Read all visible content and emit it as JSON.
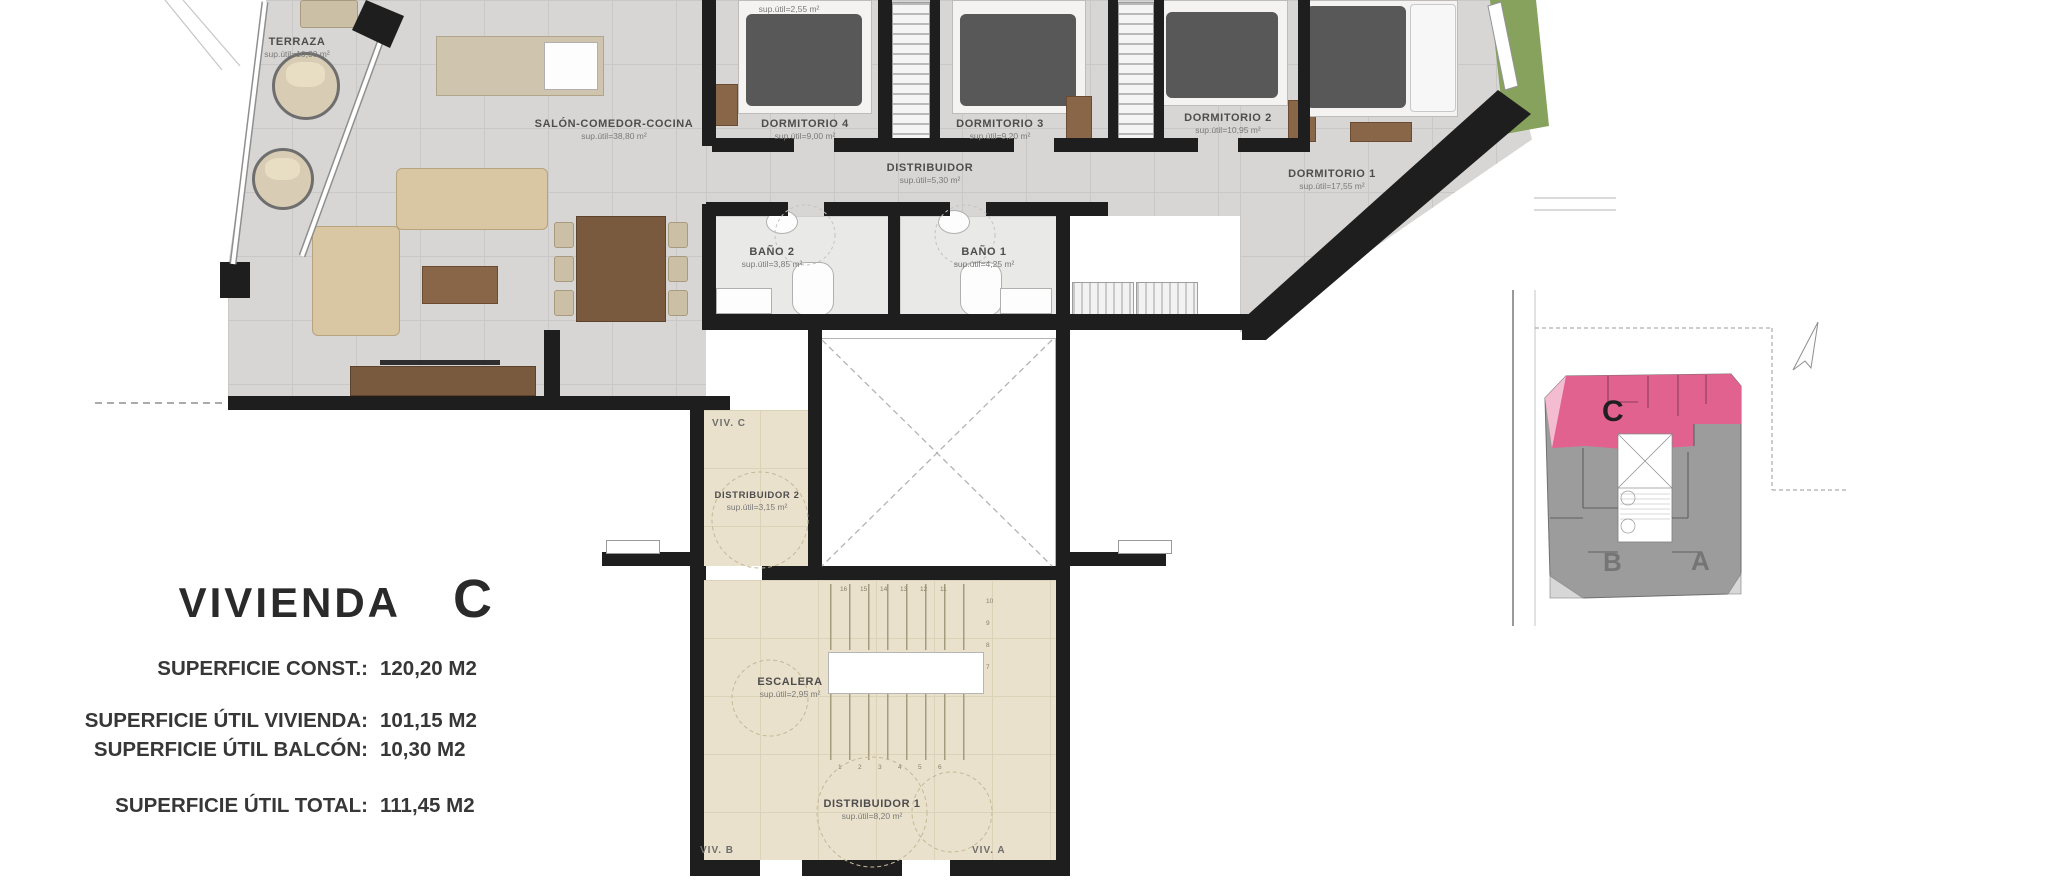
{
  "info_panel": {
    "title": "VIVIENDA",
    "unit": "C",
    "rows": [
      {
        "label": "SUPERFICIE CONST.:",
        "value": "120,20 M2"
      },
      {
        "label": "SUPERFICIE ÚTIL VIVIENDA:",
        "value": "101,15 M2"
      },
      {
        "label": "SUPERFICIE ÚTIL BALCÓN:",
        "value": "10,30 M2"
      },
      {
        "label": "SUPERFICIE ÚTIL TOTAL:",
        "value": "111,45 M2"
      }
    ]
  },
  "floor_plan": {
    "rooms": {
      "terraza": {
        "name": "TERRAZA",
        "area": "sup.útil=10,30 m²"
      },
      "salon": {
        "name": "SALÓN-COMEDOR-COCINA",
        "area": "sup.útil=38,80 m²"
      },
      "lavadero": {
        "name": "LAVADERO",
        "area": "sup.útil=2,55 m²"
      },
      "dormitorio4": {
        "name": "DORMITORIO 4",
        "area": "sup.útil=9,00 m²"
      },
      "dormitorio3": {
        "name": "DORMITORIO 3",
        "area": "sup.útil=9,20 m²"
      },
      "dormitorio2": {
        "name": "DORMITORIO 2",
        "area": "sup.útil=10,95 m²"
      },
      "dormitorio1": {
        "name": "DORMITORIO 1",
        "area": "sup.útil=17,55 m²"
      },
      "distribuidor": {
        "name": "DISTRIBUIDOR",
        "area": "sup.útil=5,30 m²"
      },
      "bano2": {
        "name": "BAÑO 2",
        "area": "sup.útil=3,85 m²"
      },
      "bano1": {
        "name": "BAÑO 1",
        "area": "sup.útil=4,25 m²"
      },
      "distribuidor2": {
        "name": "DISTRIBUIDOR 2",
        "area": "sup.útil=3,15 m²"
      },
      "escalera": {
        "name": "ESCALERA",
        "area": "sup.útil=2,95 m²"
      },
      "distribuidor1": {
        "name": "DISTRIBUIDOR 1",
        "area": "sup.útil=8,20 m²"
      }
    },
    "neighbors": {
      "viv_c": "VIV. C",
      "viv_b": "VIV. B",
      "viv_a": "VIV. A"
    },
    "stairs": {
      "top": [
        "16",
        "15",
        "14",
        "13",
        "12",
        "11"
      ],
      "right": [
        "10",
        "9",
        "8",
        "7"
      ],
      "bottom": [
        "1",
        "2",
        "3",
        "4",
        "5",
        "6"
      ]
    }
  },
  "key_plan": {
    "units": {
      "c": "C",
      "b": "B",
      "a": "A"
    },
    "highlighted_unit": "C",
    "highlight_color": "#e2628f"
  },
  "colors": {
    "wall": "#1e1e1e",
    "floor_tile": "#d7d6d4",
    "common_floor": "#eae1cd",
    "unit_highlight": "#e2628f",
    "unit_highlight_light": "#f3bcd1",
    "unit_gray": "#9c9c9c",
    "grass": "#86a25d"
  }
}
